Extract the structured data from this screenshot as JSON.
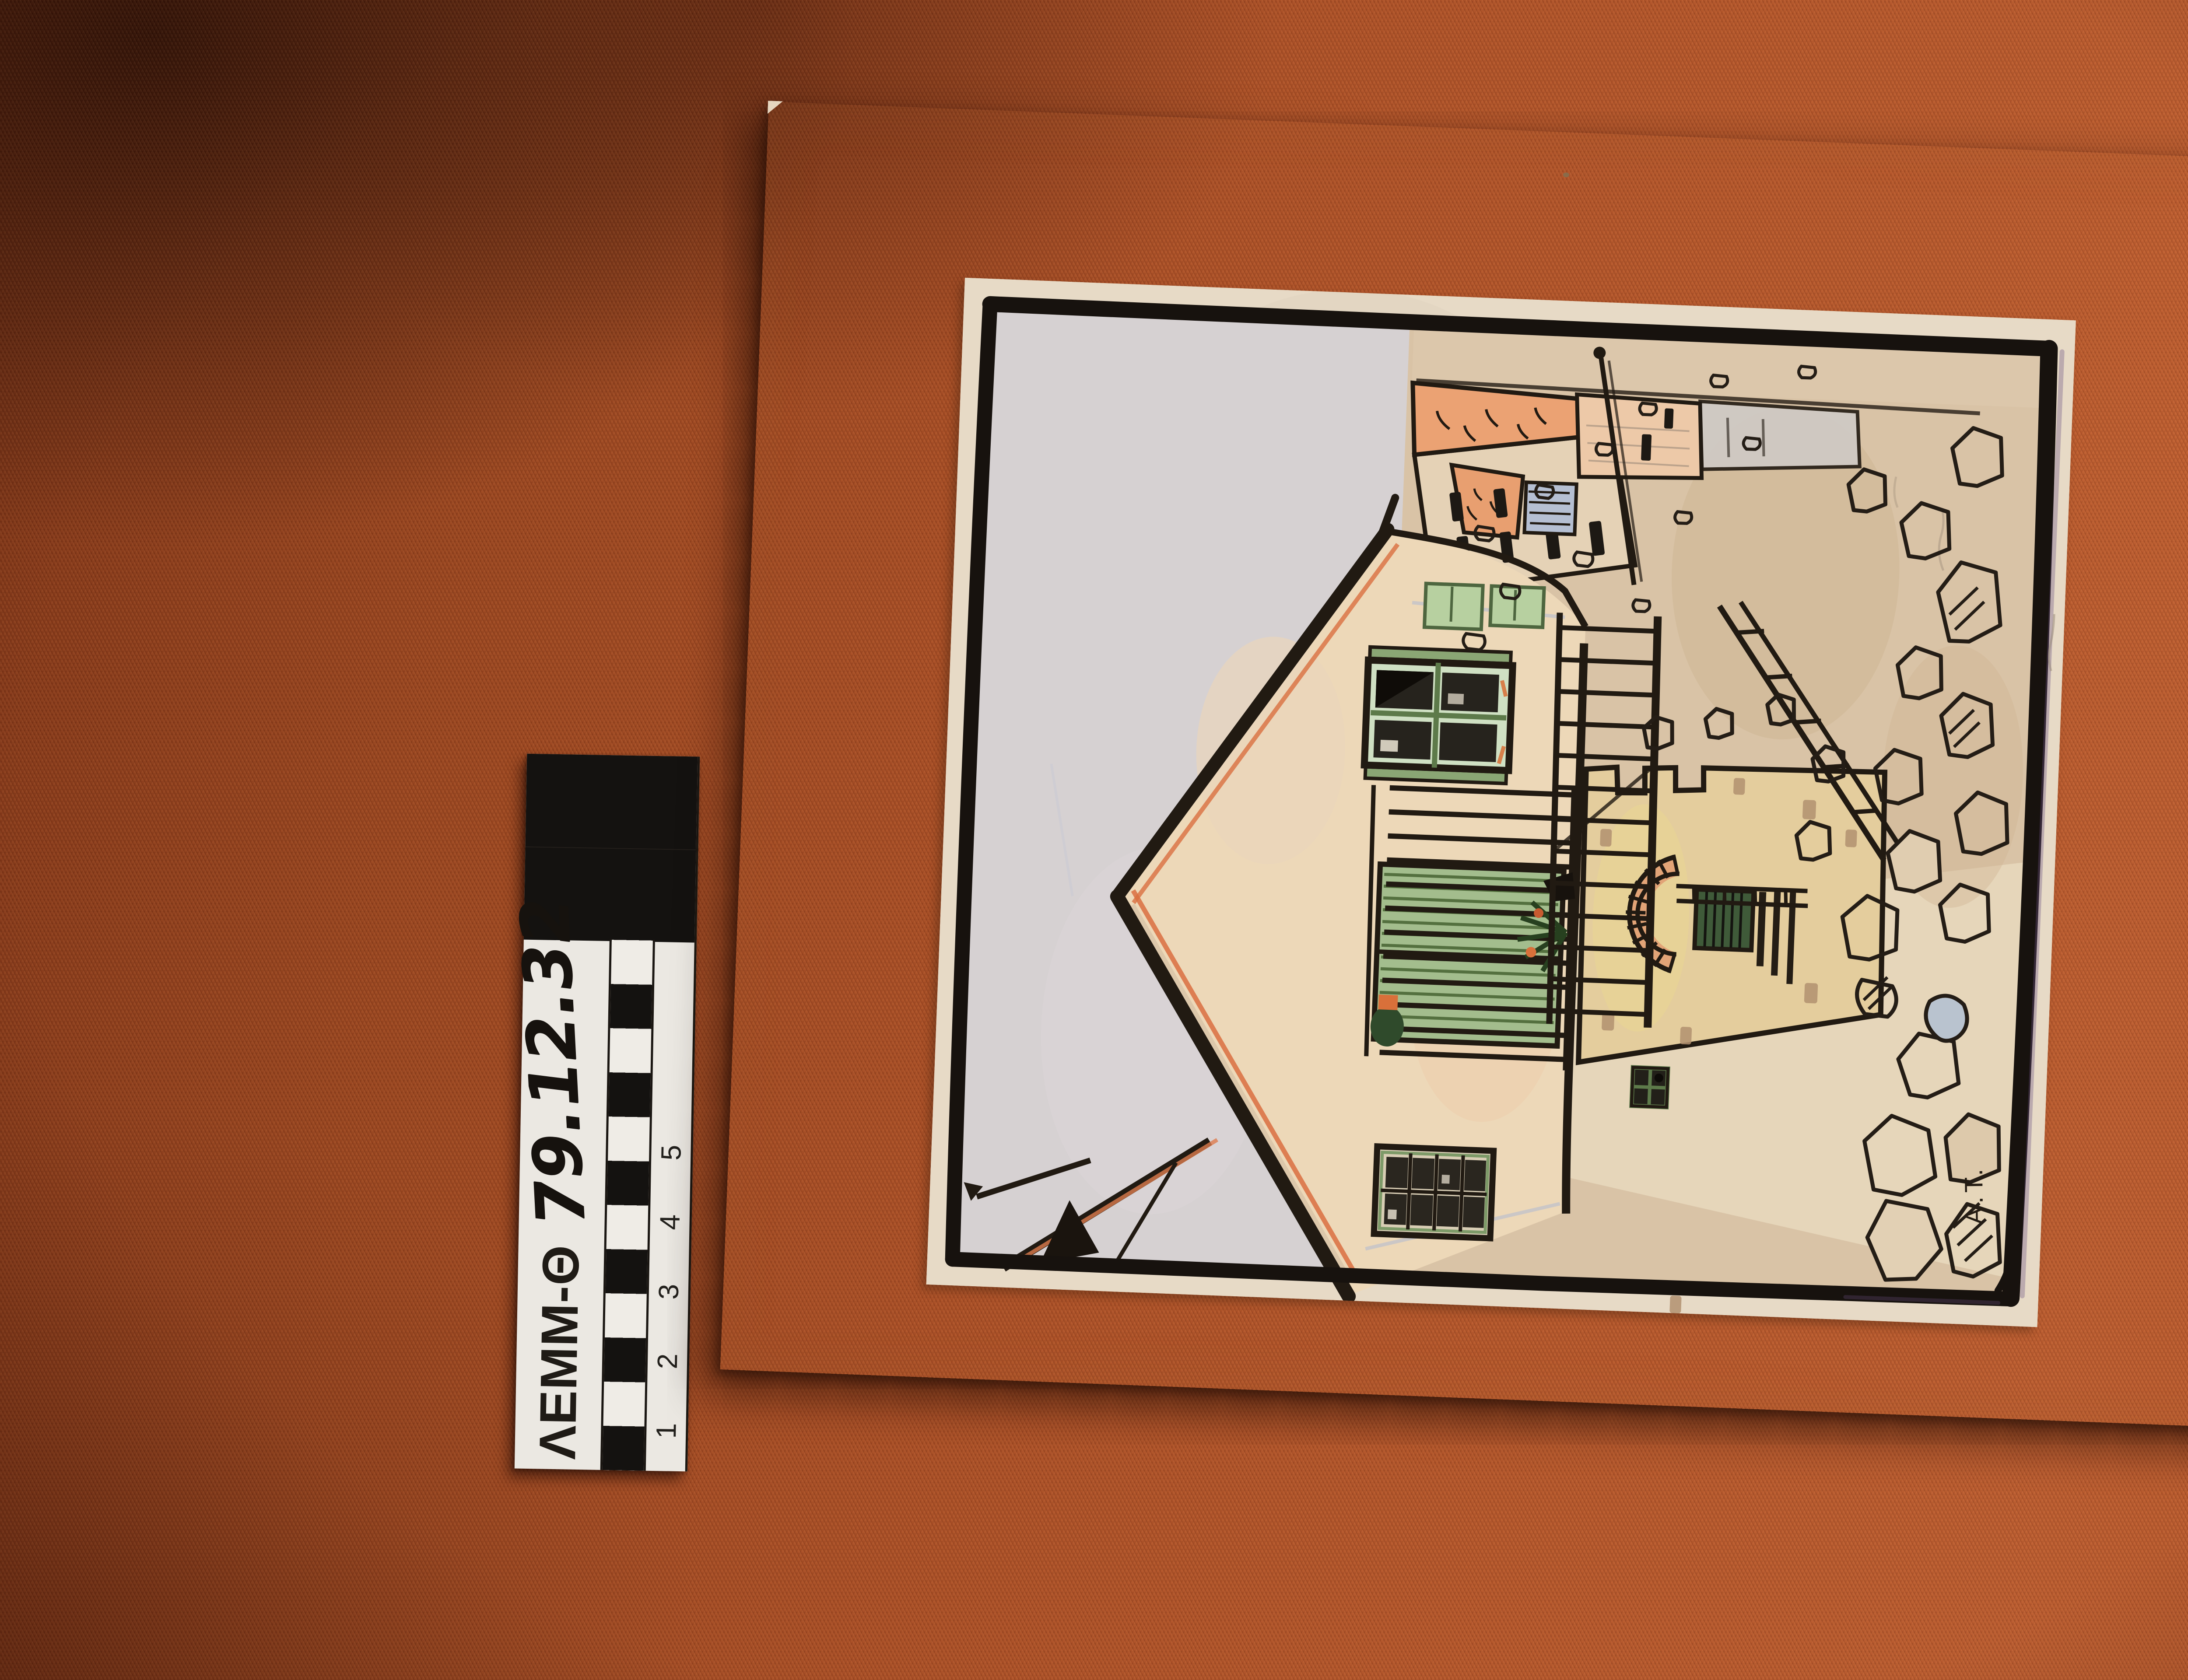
{
  "scale_bar": {
    "institution_code": "ΛEMM-Θ",
    "catalog_number": "79.12.32",
    "tick_labels": [
      "1",
      "2",
      "3",
      "4",
      "5"
    ]
  },
  "artwork": {
    "signature": "A.T."
  },
  "palette": {
    "fabric_rust": "#a84e26",
    "board_cream": "#ead7b4",
    "paper_cream": "#e7dac6",
    "sky_gray": "#d6d1d2",
    "ink_black": "#211a12",
    "shutter_green": "#7d9a68",
    "roof_orange": "#e89f70",
    "wall_yellow": "#e6cf9f",
    "arch_brick": "#e2a477",
    "pencil_blue": "#a9b6d4"
  }
}
